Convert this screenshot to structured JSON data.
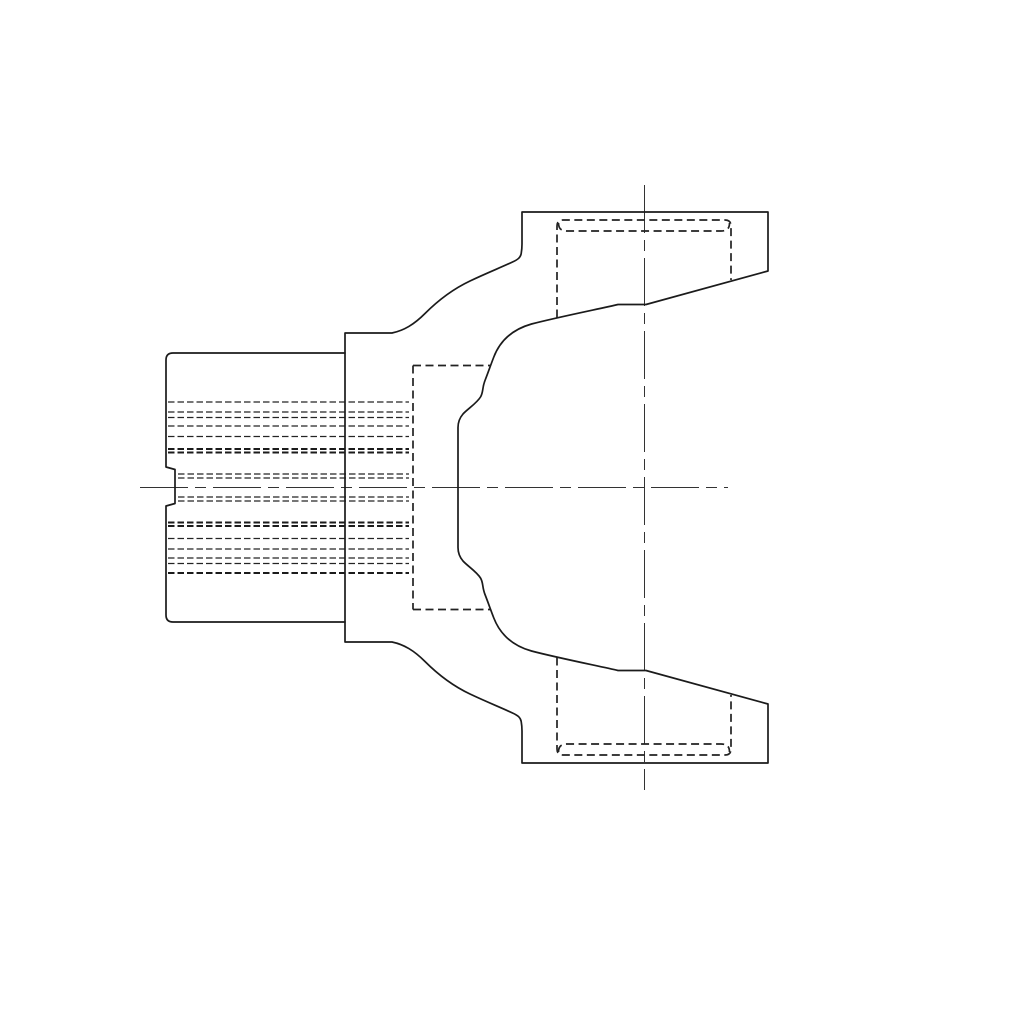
{
  "drawing": {
    "background_color": "#ffffff",
    "object_line_color": "#1b1b1b",
    "hidden_line_color": "#222222",
    "center_line_color": "#333333",
    "canvas": {
      "width": 1024,
      "height": 1024
    },
    "paths": {
      "yoke_outline": "M345,333 L392,333 C404,330.5 414,324.5 425,313.5 C437,301.5 452,289.5 470,281 C488,272.5 502,267 512.5,262 C518,259.5 520.5,257.5 521.2,253.5 C521.8,250 522,248 522,244 L522,212 L768,212 L768,271 L646,304.5 L618,304.5 C601,308.5 556,317.5 531.5,324 C512,329.5 500,341 493.8,357 C490.5,365.5 488.5,371.5 485,380.5 C482,388 483.5,392 480.5,397 C476.5,403.5 467.5,409 463,414 C459.3,418.3 458,422.5 458,427.5 L458,547.5 C458,552.5 459.3,556.7 463,561 C467.5,566 476.5,571.5 480.5,578 C483.5,583 482,587 485,594.5 C488.5,603.5 490.5,609.5 493.8,618 C500,634 512,645.5 531.5,651 C556,657.5 601,666.5 618,670.5 L646,670.5 L768,704 L768,763 L522,763 L522,731 C522,727 521.8,725 521.2,721.5 C520.5,717.5 518,715.5 512.5,713 C502,708 488,702.5 470,694 C452,685.5 437,673.5 425,661.5 C414,650.5 404,644.5 392,642 L345,642 Z",
      "shaft_outline": "M345,353 L173,353 Q166,353 166,360 L166,467 L175,469.5 L175,503.5 L166,506 L166,615 Q166,622 173,622 L345,622",
      "hidden_bore_rect": "M413,365.5 L491,365.5 M413,365.5 L413,609.5 M413,609.5 L491,609.5",
      "upper_bearing_bore": "M557,317.5 L557,226 Q557,220 563,220 L725,220 Q731,220 731,226 L731,280",
      "upper_bearing_bore_inner": "M558.5,223 C558.5,228.5 561,231 567,231 L721,231 C727,231 729.5,228.5 729.5,223",
      "lower_bearing_bore": "M557,657.5 L557,749 Q557,755 563,755 L725,755 Q731,755 731,749 L731,695",
      "lower_bearing_bore_inner": "M558.5,752 C558.5,746.5 561,744 567,744 L721,744 C727,744 729.5,746.5 729.5,752",
      "spline_lines_regular": "M168,402 L409,402 M168,412 L409,412 M168,417.5 L409,417.5 M168,426 L409,426 M168,436.5 L409,436.5 M178,474 L409,474 M178,478 L409,478 M178,497 L409,497 M178,501 L409,501 M168,538.5 L409,538.5 M168,549 L409,549 M168,558 L409,558 M168,563.5 L409,563.5",
      "spline_lines_bold": "M168,449 L409,449 M168,452.5 L409,452.5 M168,522.5 L409,522.5 M168,526 L409,526 M168,573 L409,573",
      "horizontal_centerline": "M140,487.5 L728,487.5",
      "vertical_centerline": "M644.5,185 L644.5,790"
    }
  }
}
